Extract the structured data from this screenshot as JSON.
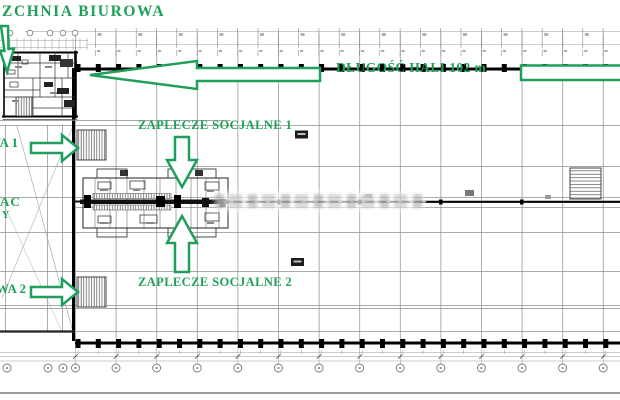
{
  "plan": {
    "accent_color": "#1FA05A",
    "office_area_label": "ZCHNIA BIUROWA",
    "hall_length_label": "DŁUGOŚĆ HALI 102 m",
    "social_area_1_label": "ZAPLECZE SOCJALNE 1",
    "social_area_2_label": "ZAPLECZE SOCJALNE 2",
    "gate_1_label": "WA 1",
    "gate_2_label": "WA 2",
    "yard_label": "AC",
    "yard_label_2": "Y"
  }
}
